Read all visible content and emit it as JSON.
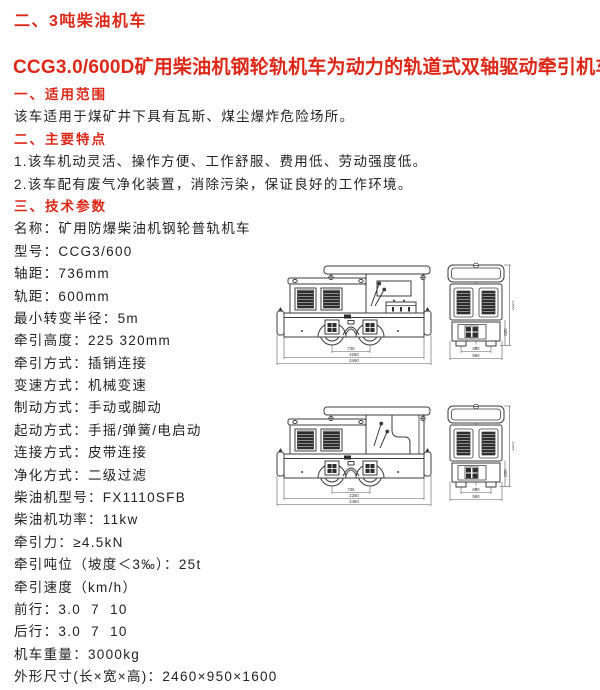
{
  "page": {
    "title": "二、3吨柴油机车",
    "subtitle": "CCG3.0/600D矿用柴油机钢轮轨机车为动力的轨道式双轴驱动牵引机车",
    "accent_color": "#dd2818",
    "text_color": "#232323",
    "background_color": "#ffffff"
  },
  "sections": [
    {
      "heading": "一、适用范围",
      "lines": [
        "该车适用于煤矿井下具有瓦斯、煤尘爆炸危险场所。"
      ]
    },
    {
      "heading": "二、主要特点",
      "lines": [
        "1.该车机动灵活、操作方便、工作舒服、费用低、劳动强度低。",
        "2.该车配有废气净化装置，消除污染，保证良好的工作环境。"
      ]
    },
    {
      "heading": "三、技术参数",
      "specs": [
        {
          "label": "名称",
          "value": "矿用防爆柴油机钢轮普轨机车"
        },
        {
          "label": "型号",
          "value": "CCG3/600"
        },
        {
          "label": "轴距",
          "value": "736mm"
        },
        {
          "label": "轨距",
          "value": "600mm"
        },
        {
          "label": "最小转变半径",
          "value": "5m"
        },
        {
          "label": "牵引高度",
          "value": "225 320mm"
        },
        {
          "label": "牵引方式",
          "value": "插销连接"
        },
        {
          "label": "变速方式",
          "value": "机械变速"
        },
        {
          "label": "制动方式",
          "value": "手动或脚动"
        },
        {
          "label": "起动方式",
          "value": "手摇/弹簧/电启动"
        },
        {
          "label": "连接方式",
          "value": "皮带连接"
        },
        {
          "label": "净化方式",
          "value": "二级过滤"
        },
        {
          "label": "柴油机型号",
          "value": "FX1110SFB"
        },
        {
          "label": "柴油机功率",
          "value": "11kw"
        },
        {
          "label": "牵引力",
          "value": "≥4.5kN"
        },
        {
          "label": "牵引吨位（坡度＜3‰）",
          "value": "25t"
        },
        {
          "label": "牵引速度（km/h）",
          "value": ""
        },
        {
          "label": "前行",
          "value": "3.0  7  10"
        },
        {
          "label": "后行",
          "value": "3.0  7  10"
        },
        {
          "label": "机车重量",
          "value": "3000kg"
        },
        {
          "label": "外形尺寸(长×宽×高)",
          "value": "2460×950×1600"
        }
      ]
    }
  ],
  "drawings": {
    "dimensions": {
      "wheelbase": "736",
      "frame_length": "2250",
      "overall_length": "2460",
      "gauge": "600",
      "overall_width": "950",
      "overall_height": "1600",
      "coupler_height": "320"
    }
  }
}
